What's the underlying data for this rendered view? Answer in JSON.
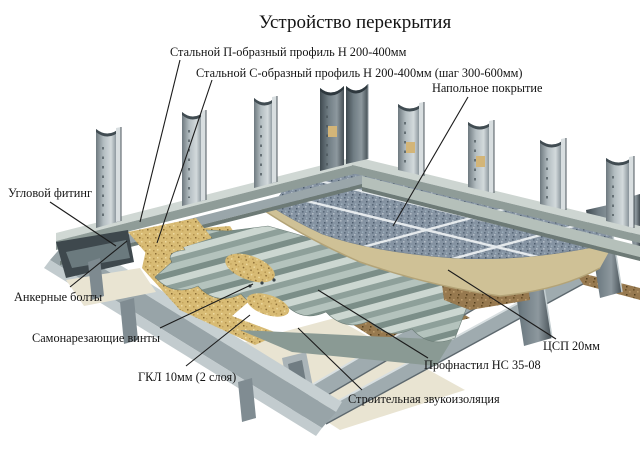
{
  "title": "Устройство перекрытия",
  "palette": {
    "ink": "#141414",
    "background": "#ffffff",
    "tile": "#8593a2",
    "sand": "#d8bb74",
    "board_tan": "#cfc196",
    "board_brown": "#97794f",
    "gypsum_cream": "#e9e4d2",
    "deck": "#a9b9b3",
    "steel_light": "#c7d0d2",
    "steel_mid": "#9aa6aa",
    "steel_dark": "#5f6a70"
  },
  "diagram": {
    "labels": {
      "p_profile": "Стальной П-образный профиль Н 200-400мм",
      "c_profile": "Стальной С-образный профиль Н 200-400мм (шаг 300-600мм)",
      "floor_covering": "Напольное покрытие",
      "corner_fitting": "Угловой фитинг",
      "anchor_bolts": "Анкерные болты",
      "self_tapping_screws": "Самонарезающие винты",
      "gkl": "ГКЛ 10мм (2 слоя)",
      "sound_insulation": "Строительная звукоизоляция",
      "profiled_sheet": "Профнастил НС 35-08",
      "csp": "ЦСП 20мм"
    }
  }
}
